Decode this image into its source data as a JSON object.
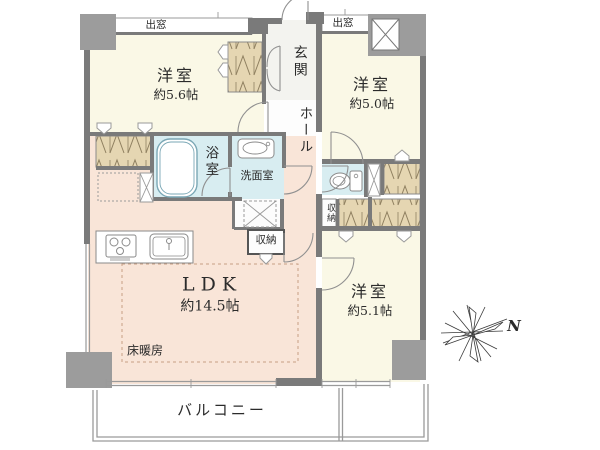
{
  "floorplan": {
    "bedroom_nw": {
      "label": "洋室",
      "size": "約5.6帖"
    },
    "bedroom_ne": {
      "label": "洋室",
      "size": "約5.0帖"
    },
    "bedroom_se": {
      "label": "洋室",
      "size": "約5.1帖"
    },
    "ldk": {
      "label": "LDK",
      "size": "約14.5帖"
    },
    "floor_heating": {
      "label": "床暖房"
    },
    "entrance": {
      "label": "玄関"
    },
    "hall": {
      "label": "ホール"
    },
    "bathroom": {
      "label": "浴室"
    },
    "washroom": {
      "label": "洗面室"
    },
    "storage_ldk": {
      "label": "収納"
    },
    "storage_hall": {
      "label": "収納"
    },
    "bay_window_nw": {
      "label": "出窓"
    },
    "bay_window_ne": {
      "label": "出窓"
    },
    "balcony": {
      "label": "バルコニー"
    },
    "compass": {
      "north": "N"
    }
  },
  "colors": {
    "room": "#faf8e6",
    "ldk": "#f9e5d8",
    "wet_area": "#d8edf1",
    "closet": "#e5d6b2",
    "wall": "#7a7a7a",
    "structure": "#9c9c9c"
  }
}
